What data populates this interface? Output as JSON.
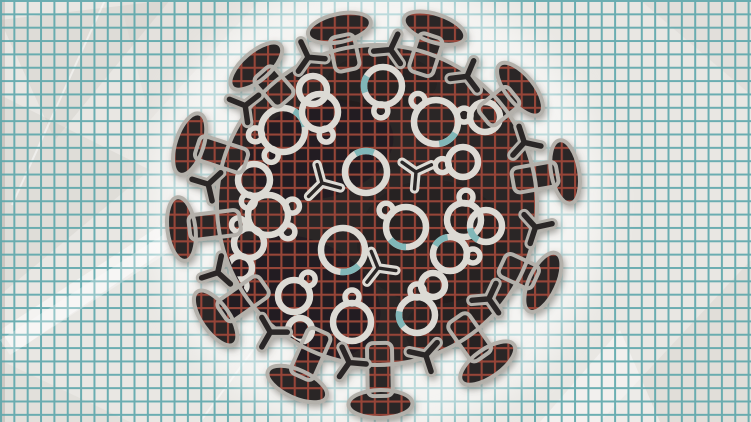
{
  "illustration": {
    "subject": "coronavirus-particle-on-crumpled-graph-paper",
    "canvas": {
      "width": 751,
      "height": 422
    },
    "colors": {
      "paper": "#e9e7e3",
      "grid_teal": "#55a3a8",
      "grid_red": "#9c4539",
      "virus_body": "#2b2627",
      "virus_shading": "#171314",
      "outline_gray": "#b3b0aa",
      "protein_white": "#dcdad4",
      "protein_inner": "#2b2627",
      "accent_teal": "#77b3b5",
      "halo_white": "#ffffff",
      "shadow_gray": "#55514b"
    },
    "grid": {
      "spacing_px": 13.35,
      "teal_line_px": 2,
      "red_line_px": 2.2
    },
    "virus": {
      "center": {
        "x": 377,
        "y": 205
      },
      "body_radius": 160,
      "spike": {
        "stalk_inner_radius": 138,
        "stalk_width": 25,
        "head_rx": 14,
        "head_ry": 32,
        "outline_px": 4
      },
      "spikes": [
        {
          "angle": -162,
          "head_dist": 197
        },
        {
          "angle": -131,
          "head_dist": 184
        },
        {
          "angle": -102,
          "head_dist": 181
        },
        {
          "angle": -72,
          "head_dist": 186
        },
        {
          "angle": -39,
          "head_dist": 184
        },
        {
          "angle": -10,
          "head_dist": 191
        },
        {
          "angle": 25,
          "head_dist": 183
        },
        {
          "angle": 55,
          "head_dist": 193
        },
        {
          "angle": 89,
          "head_dist": 199
        },
        {
          "angle": 114,
          "head_dist": 196
        },
        {
          "angle": 145,
          "head_dist": 197
        },
        {
          "angle": 173,
          "head_dist": 197
        }
      ],
      "small_spikes": [
        {
          "angle": -173,
          "dist": 170,
          "rot": 10
        },
        {
          "angle": -143,
          "dist": 165,
          "rot": -15
        },
        {
          "angle": -115,
          "dist": 163,
          "rot": 0
        },
        {
          "angle": -85,
          "dist": 156,
          "rot": 20
        },
        {
          "angle": -55,
          "dist": 157,
          "rot": -12
        },
        {
          "angle": -23,
          "dist": 160,
          "rot": 35
        },
        {
          "angle": 8,
          "dist": 160,
          "rot": -20
        },
        {
          "angle": 40,
          "dist": 146,
          "rot": 15
        },
        {
          "angle": 72,
          "dist": 158,
          "rot": 0
        },
        {
          "angle": 100,
          "dist": 160,
          "rot": 25
        },
        {
          "angle": 130,
          "dist": 166,
          "rot": -10
        },
        {
          "angle": 157,
          "dist": 173,
          "rot": 5
        }
      ],
      "proteins": [
        {
          "type": "double",
          "x": 283,
          "y": 130,
          "r": 22,
          "knobs": [
            115,
            170
          ],
          "accent": -60
        },
        {
          "type": "knob",
          "x": 320,
          "y": 112,
          "r": 18,
          "knobs": [
            75
          ]
        },
        {
          "type": "knob",
          "x": 383,
          "y": 86,
          "r": 19,
          "knobs": [
            95
          ],
          "accent": 160
        },
        {
          "type": "knob",
          "x": 436,
          "y": 122,
          "r": 22,
          "knobs": [
            -130
          ],
          "accent": 30
        },
        {
          "type": "knob",
          "x": 463,
          "y": 162,
          "r": 15,
          "knobs": [
            170
          ]
        },
        {
          "type": "ring",
          "x": 366,
          "y": 172,
          "r": 21,
          "accent": -120
        },
        {
          "type": "y",
          "x": 322,
          "y": 183,
          "r": 19,
          "rot": 15
        },
        {
          "type": "y",
          "x": 416,
          "y": 172,
          "r": 17,
          "rot": -25
        },
        {
          "type": "double",
          "x": 268,
          "y": 215,
          "r": 20,
          "knobs": [
            -20,
            40
          ]
        },
        {
          "type": "ring",
          "x": 343,
          "y": 250,
          "r": 22,
          "accent": 45
        },
        {
          "type": "knob",
          "x": 406,
          "y": 227,
          "r": 20,
          "knobs": [
            -140
          ],
          "accent": 90
        },
        {
          "type": "knob",
          "x": 464,
          "y": 220,
          "r": 17,
          "knobs": [
            -85
          ]
        },
        {
          "type": "knob",
          "x": 249,
          "y": 243,
          "r": 15,
          "knobs": [
            -120
          ]
        },
        {
          "type": "knob",
          "x": 294,
          "y": 296,
          "r": 16,
          "knobs": [
            -50
          ]
        },
        {
          "type": "y",
          "x": 378,
          "y": 268,
          "r": 18,
          "rot": 8
        },
        {
          "type": "knob",
          "x": 450,
          "y": 254,
          "r": 17,
          "knobs": [
            5
          ],
          "accent": -150
        },
        {
          "type": "knob",
          "x": 352,
          "y": 322,
          "r": 19,
          "knobs": [
            -90
          ]
        },
        {
          "type": "knob",
          "x": 417,
          "y": 315,
          "r": 18,
          "knobs": [
            -90
          ],
          "accent": 140
        },
        {
          "type": "ring",
          "x": 300,
          "y": 330,
          "r": 12
        },
        {
          "type": "ring",
          "x": 486,
          "y": 226,
          "r": 16,
          "accent": 120
        },
        {
          "type": "ring",
          "x": 313,
          "y": 90,
          "r": 14
        },
        {
          "type": "knob",
          "x": 485,
          "y": 117,
          "r": 15,
          "knobs": [
            -175
          ]
        },
        {
          "type": "knob",
          "x": 254,
          "y": 180,
          "r": 16,
          "knobs": [
            105
          ]
        },
        {
          "type": "ring",
          "x": 433,
          "y": 285,
          "r": 12
        },
        {
          "type": "knob",
          "x": 240,
          "y": 268,
          "r": 12,
          "knobs": [
            90
          ]
        }
      ]
    }
  }
}
